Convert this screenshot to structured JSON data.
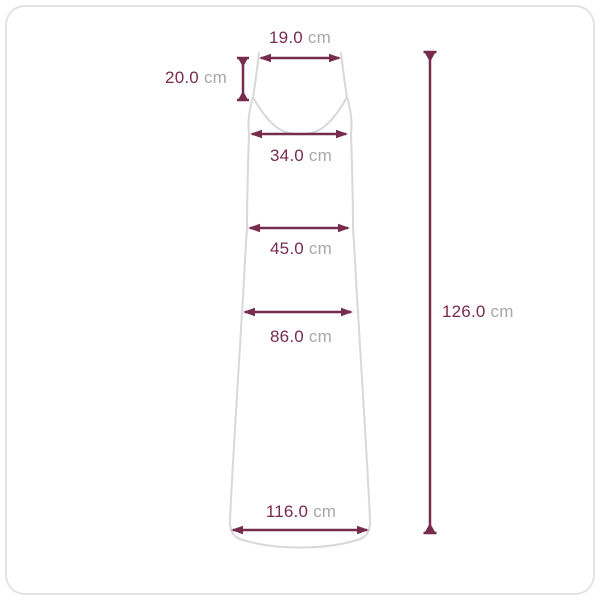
{
  "diagram": {
    "subject": "sleeveless-maxi-dress-size-diagram",
    "unit": "cm"
  },
  "measurements": {
    "strap_width": {
      "value": "19.0",
      "unit": "cm"
    },
    "strap_length": {
      "value": "20.0",
      "unit": "cm"
    },
    "bust_width": {
      "value": "34.0",
      "unit": "cm"
    },
    "waist_width": {
      "value": "45.0",
      "unit": "cm"
    },
    "hip_width": {
      "value": "86.0",
      "unit": "cm"
    },
    "hem_width": {
      "value": "116.0",
      "unit": "cm"
    },
    "total_length": {
      "value": "126.0",
      "unit": "cm"
    }
  },
  "colors": {
    "dimension": "#772c4e",
    "garment_outline": "#d8d8d8",
    "unit_text": "#a8a8a8",
    "frame_border": "#e3e3e3",
    "background": "#ffffff"
  }
}
